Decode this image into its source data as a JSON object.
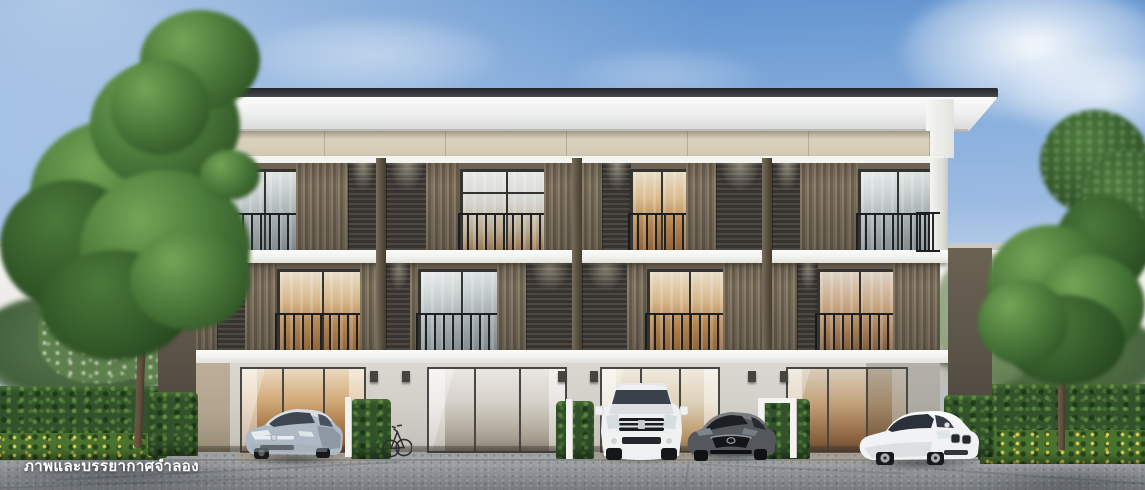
{
  "watermark": {
    "text": "ภาพและบรรยากาศจำลอง"
  },
  "building": {
    "units_visible": 4,
    "floors_visible": 3
  },
  "vehicles": [
    "silver-sedan",
    "white-suv",
    "gray-sedan",
    "white-coupe"
  ],
  "colors": {
    "sky_top": "#5d90cc",
    "sky_mid": "#9cbbe2",
    "sky_horizon": "#eef0ee",
    "roof_dark": "#2f3337",
    "roof_fascia": "#f4f5f4",
    "cream_band": "#d8cfba",
    "slab_white": "#f3f3f0",
    "slat_brown": "#7a6d5a",
    "louver_dark": "#37342f",
    "post_brown": "#564d3e",
    "end_wall": "#5a5246",
    "wall_gray": "#d3d0c9",
    "wall_tan": "#b2a48e",
    "frame_dark": "#33332f",
    "hedge_base": "#31522a",
    "hedge_light": "#6f9a4a",
    "hedge_dark": "#1e3319",
    "flower_yellow": "#d9c74e",
    "tree_light": "#74a455",
    "tree_mid": "#4a7a3a",
    "tree_dark": "#2a4d22",
    "trunk_brown": "#5f4f3c",
    "pavement_light": "#c8cac9",
    "pavement_dark": "#74787c",
    "bg_building": "#f6f5f2",
    "car_silver": "#aeb9c5",
    "car_white_suv": "#eef0f1",
    "car_gray": "#54585c",
    "car_white_coupe": "#f1f2f3",
    "watermark_white": "#ffffff"
  }
}
